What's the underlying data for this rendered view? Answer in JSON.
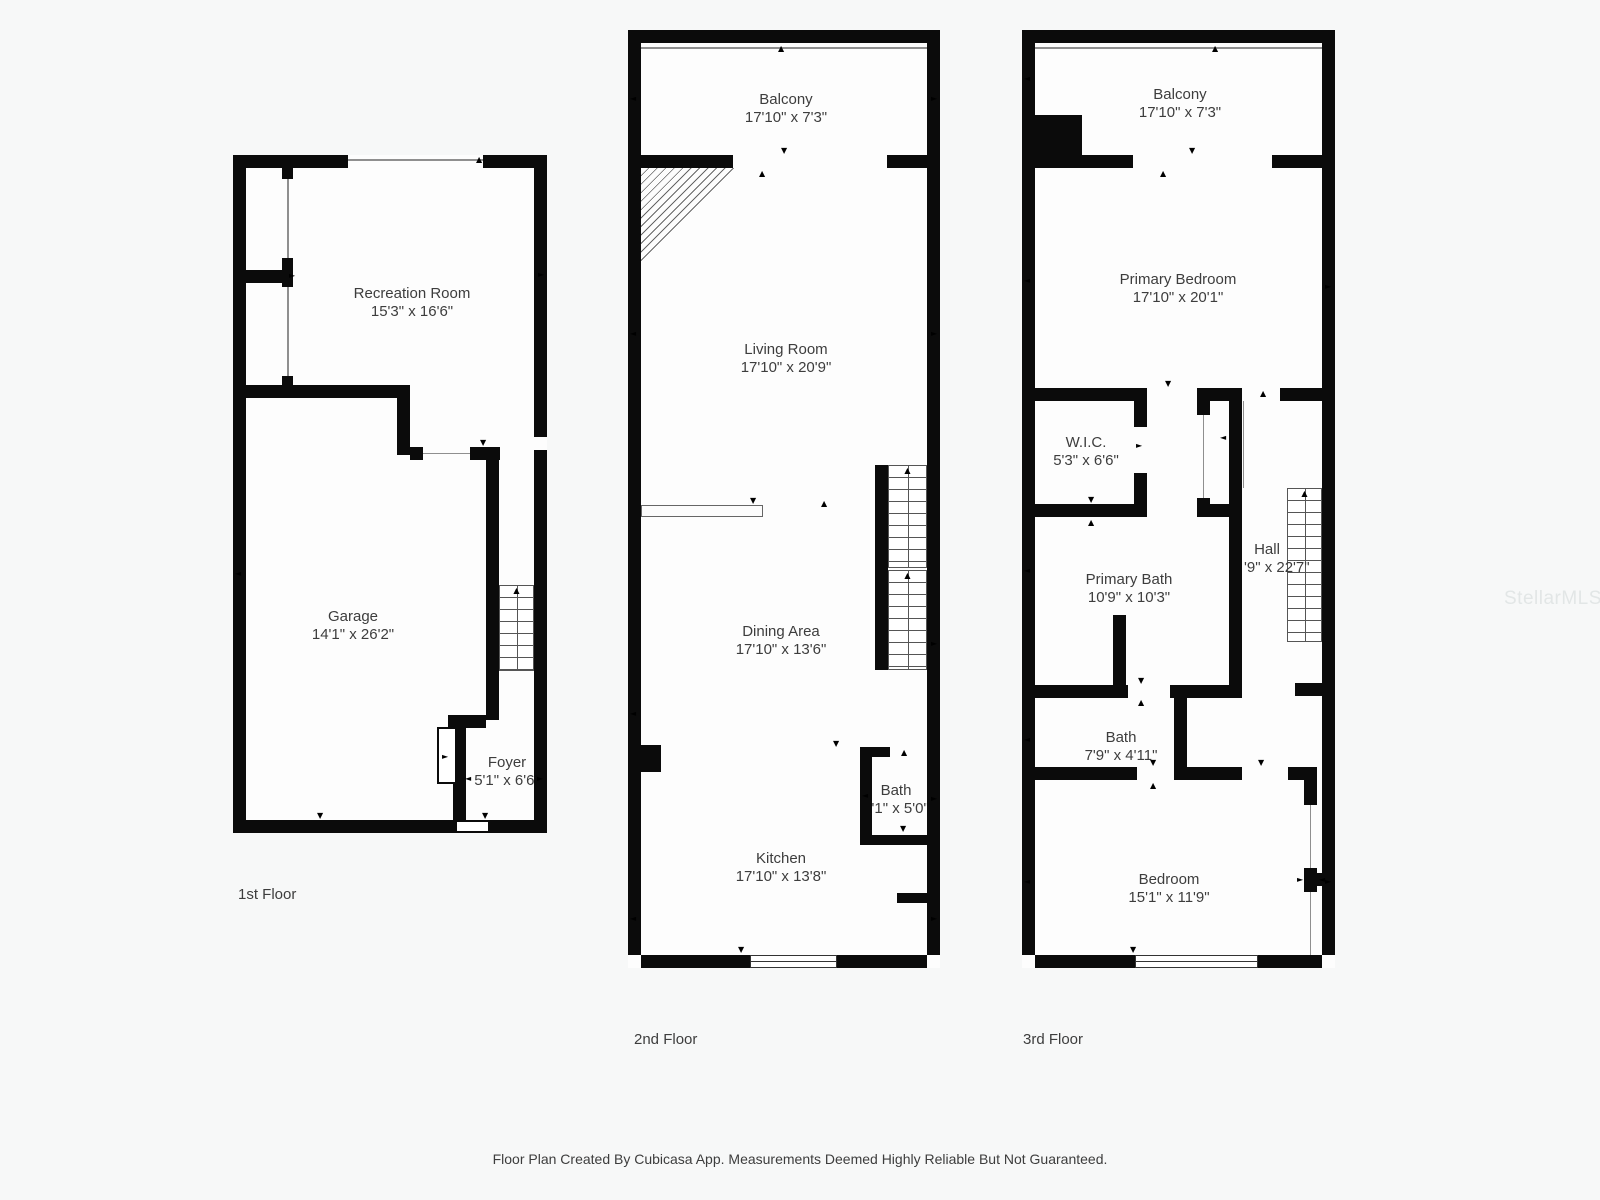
{
  "icons": {
    "up": "▲",
    "down": "▼",
    "left": "◄",
    "right": "►"
  },
  "colors": {
    "wall": "#0b0b0b",
    "background": "#f7f8f8",
    "text": "#3d3d3d",
    "watermark": "#e2e6e6"
  },
  "floors": [
    {
      "label": "1st Floor",
      "rooms": [
        {
          "name": "Recreation Room",
          "dims": "15'3\" x 16'6\""
        },
        {
          "name": "Garage",
          "dims": "14'1\" x 26'2\""
        },
        {
          "name": "Foyer",
          "dims": "5'1\" x 6'6\""
        }
      ]
    },
    {
      "label": "2nd Floor",
      "rooms": [
        {
          "name": "Balcony",
          "dims": "17'10\" x 7'3\""
        },
        {
          "name": "Living Room",
          "dims": "17'10\" x 20'9\""
        },
        {
          "name": "Dining Area",
          "dims": "17'10\" x 13'6\""
        },
        {
          "name": "Bath",
          "dims": "5'1\" x 5'0\""
        },
        {
          "name": "Kitchen",
          "dims": "17'10\" x 13'8\""
        }
      ]
    },
    {
      "label": "3rd Floor",
      "rooms": [
        {
          "name": "Balcony",
          "dims": "17'10\" x 7'3\""
        },
        {
          "name": "Primary Bedroom",
          "dims": "17'10\" x 20'1\""
        },
        {
          "name": "W.I.C.",
          "dims": "5'3\" x 6'6\""
        },
        {
          "name": "Primary Bath",
          "dims": "10'9\" x 10'3\""
        },
        {
          "name": "Hall",
          "dims": "'9\" x 22'7\""
        },
        {
          "name": "Bath",
          "dims": "7'9\" x 4'11\""
        },
        {
          "name": "Bedroom",
          "dims": "15'1\" x 11'9\""
        }
      ]
    }
  ],
  "footer": "Floor Plan Created By Cubicasa App. Measurements Deemed Highly Reliable But Not Guaranteed.",
  "watermark": "StellarMLS"
}
